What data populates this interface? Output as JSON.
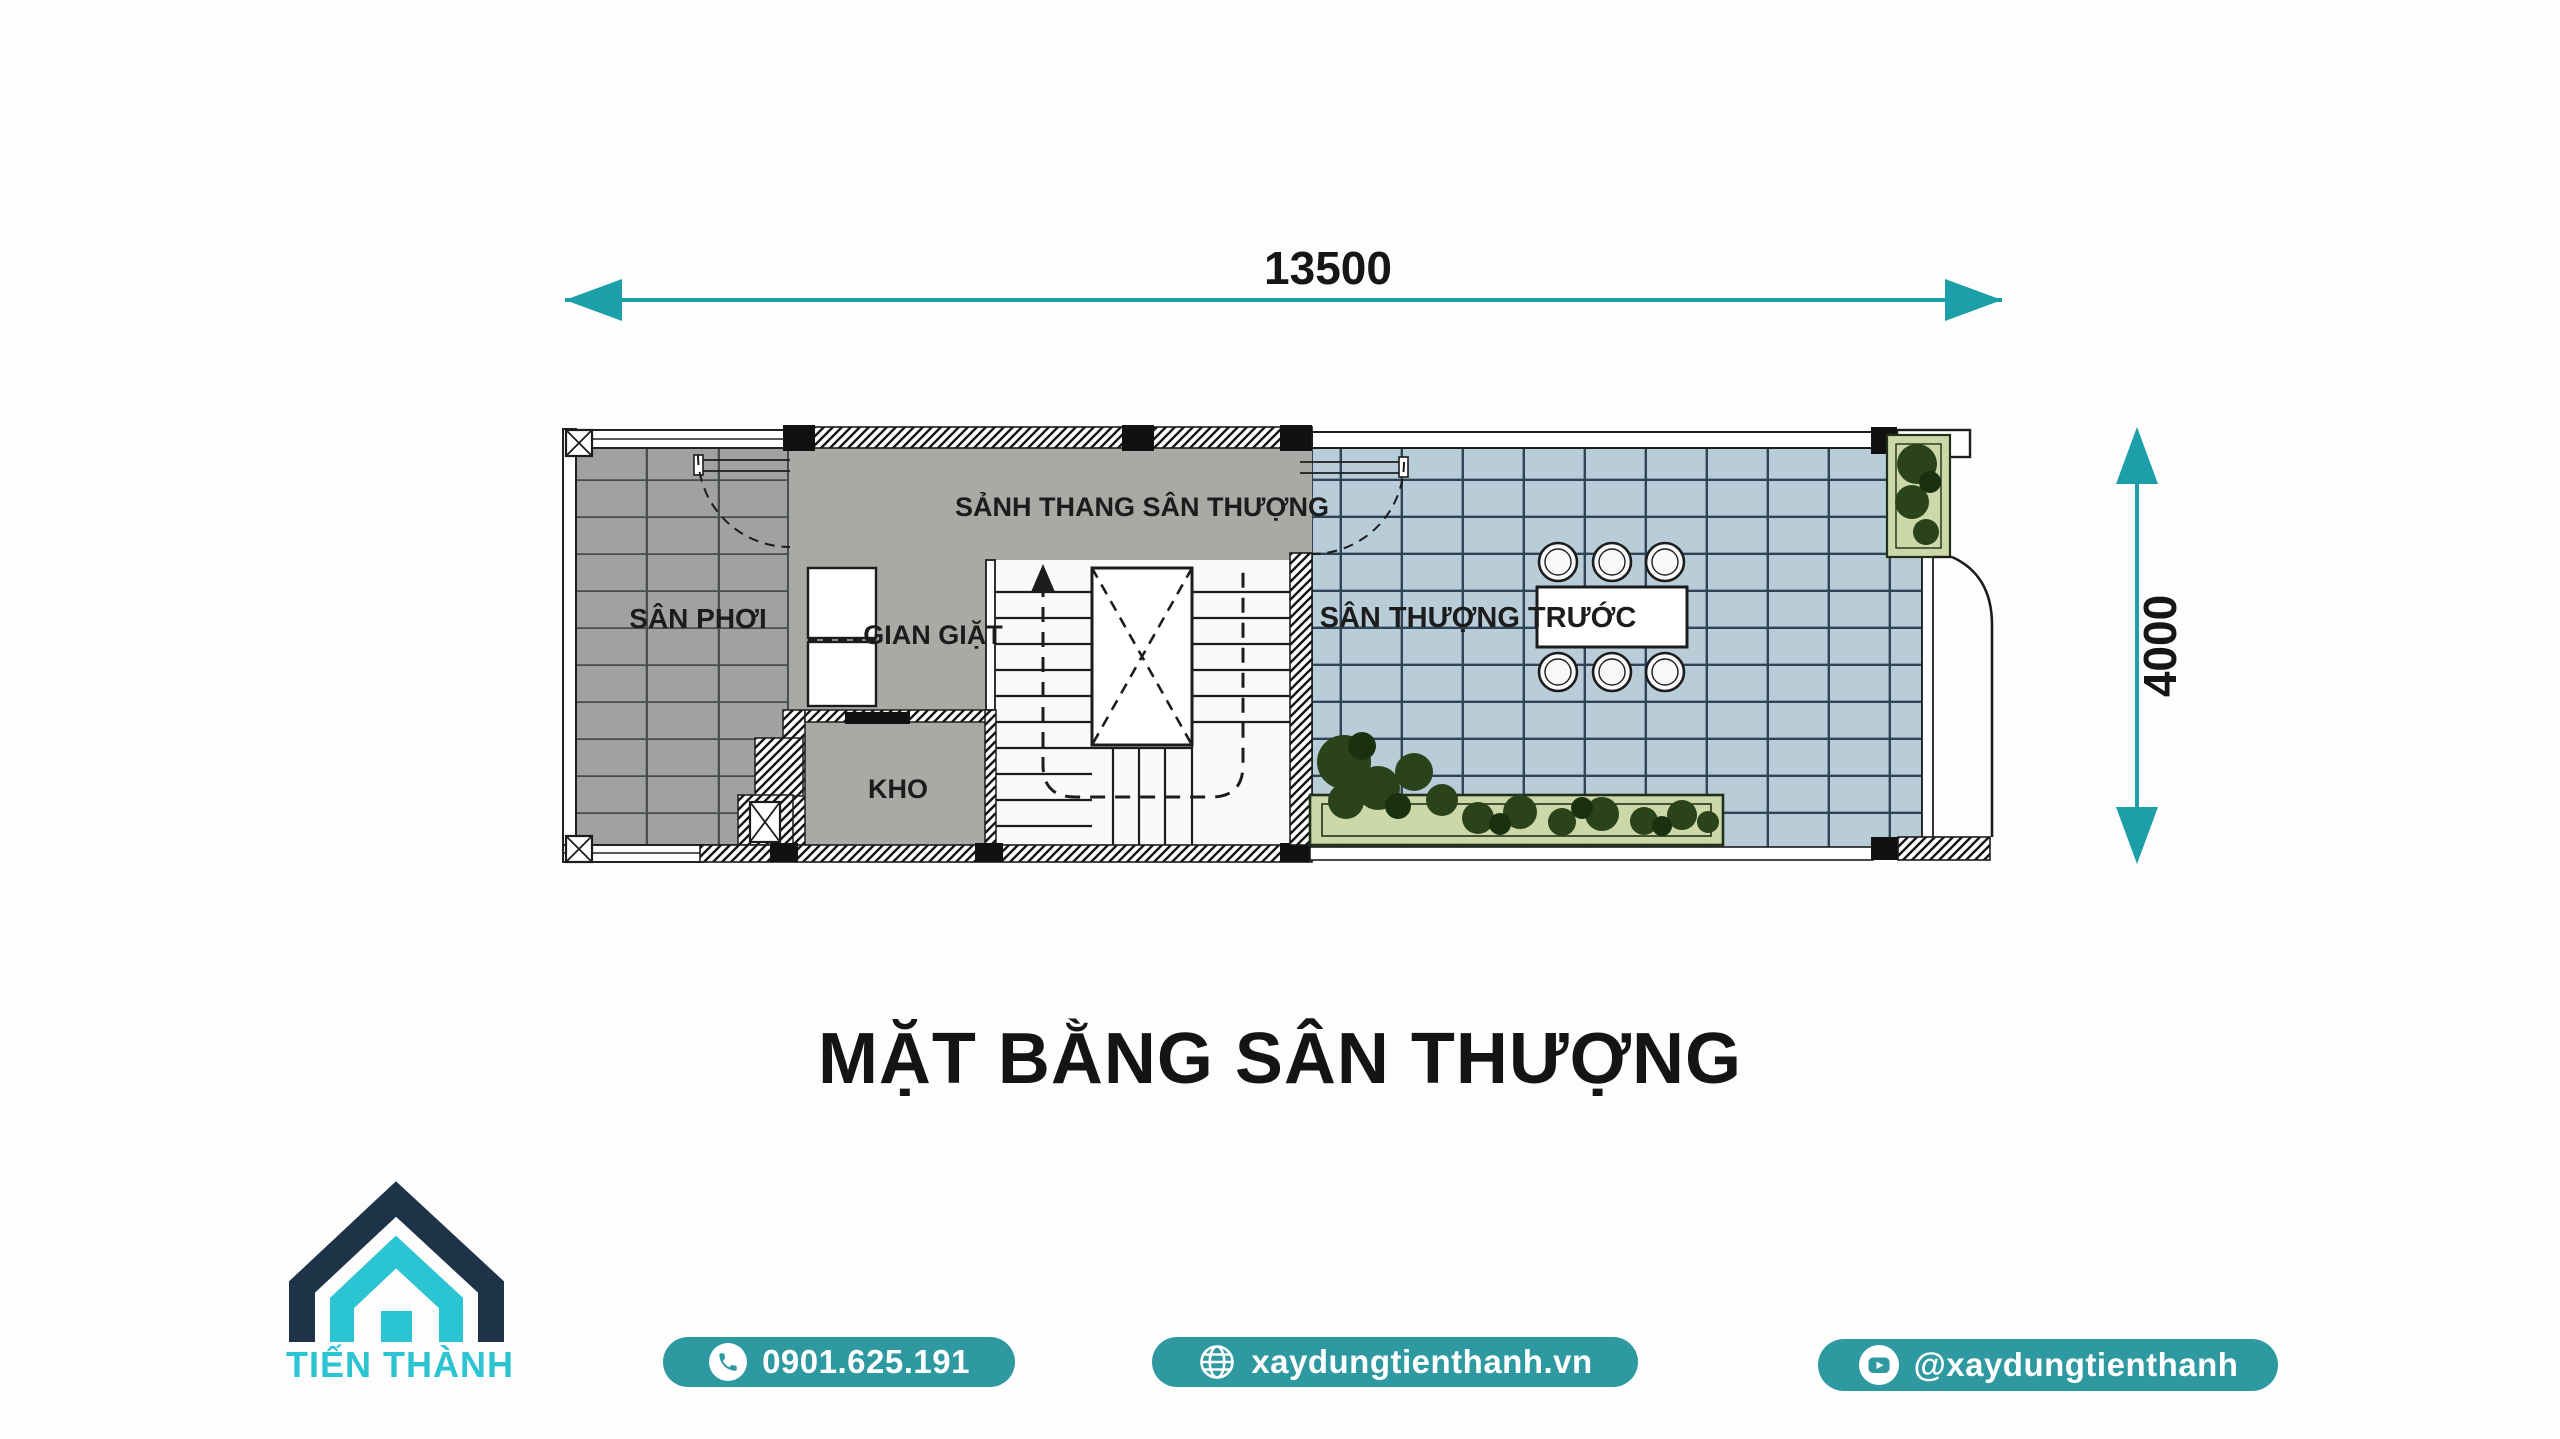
{
  "page": {
    "title": "MẶT BẰNG SÂN THƯỢNG"
  },
  "plan": {
    "dimension_width": "13500",
    "dimension_depth": "4000",
    "rooms": {
      "san_phoi": "SÂN PHƠI",
      "gian_giat": "GIAN GIẶT",
      "kho": "KHO",
      "sanh_thang": "SẢNH THANG SÂN THƯỢNG",
      "san_thuong_truoc": "SÂN THƯỢNG TRƯỚC"
    }
  },
  "footer": {
    "brand": "TIẾN THÀNH",
    "phone": "0901.625.191",
    "website": "xaydungtienthanh.vn",
    "social_handle": "@xaydungtienthanh"
  },
  "colors": {
    "accent_teal": "#1c9fa9",
    "button_teal": "#2e99a1",
    "logo_cyan": "#2ac4d3",
    "logo_navy": "#1e3348",
    "floor_gray": "#a8aaa5",
    "drying_tile_gray": "#9fa2a0",
    "terrace_tile_blue": "#b9cdd9",
    "planter_green": "#ccd8a8"
  }
}
